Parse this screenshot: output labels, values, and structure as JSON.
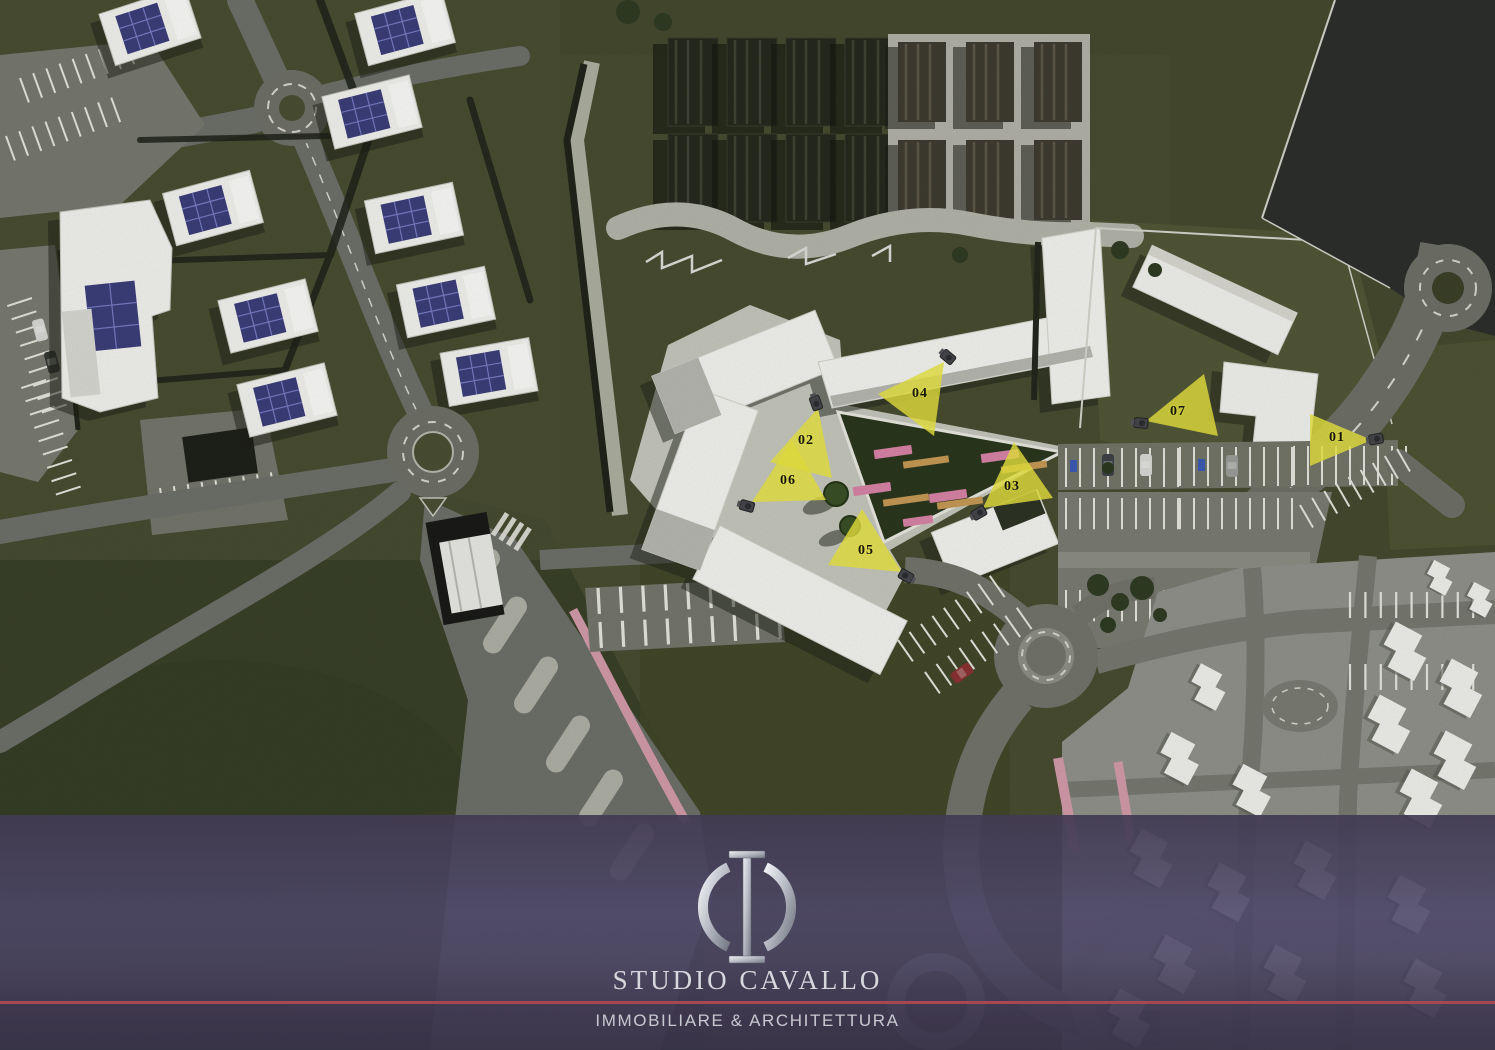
{
  "scene": {
    "type": "architectural-site-plan-render",
    "view": "aerial-top-down",
    "palette": {
      "grass": "#454a2f",
      "road": "#6f7168",
      "pavement": "#c6c7bd",
      "building_white": "#f4f4f0",
      "solar_panel_blue": "#3c3e7a",
      "bench_pink": "#d984a6",
      "bench_wood": "#c79a56",
      "cycle_path_pink": "#d49cab",
      "marker_yellow": "#eae73f"
    }
  },
  "markers": {
    "color": "#eae73f",
    "number_color": "#16160e",
    "items": [
      {
        "label": "01"
      },
      {
        "label": "02"
      },
      {
        "label": "03"
      },
      {
        "label": "04"
      },
      {
        "label": "05"
      },
      {
        "label": "06"
      },
      {
        "label": "07"
      }
    ]
  },
  "footer": {
    "logo": "phi-monogram-icon",
    "brand_name": "STUDIO CAVALLO",
    "tagline": "IMMOBILIARE & ARCHITETTURA",
    "accent_line_color": "#a84750",
    "band_color": "#4d4768",
    "text_color": "#d7d7de"
  }
}
